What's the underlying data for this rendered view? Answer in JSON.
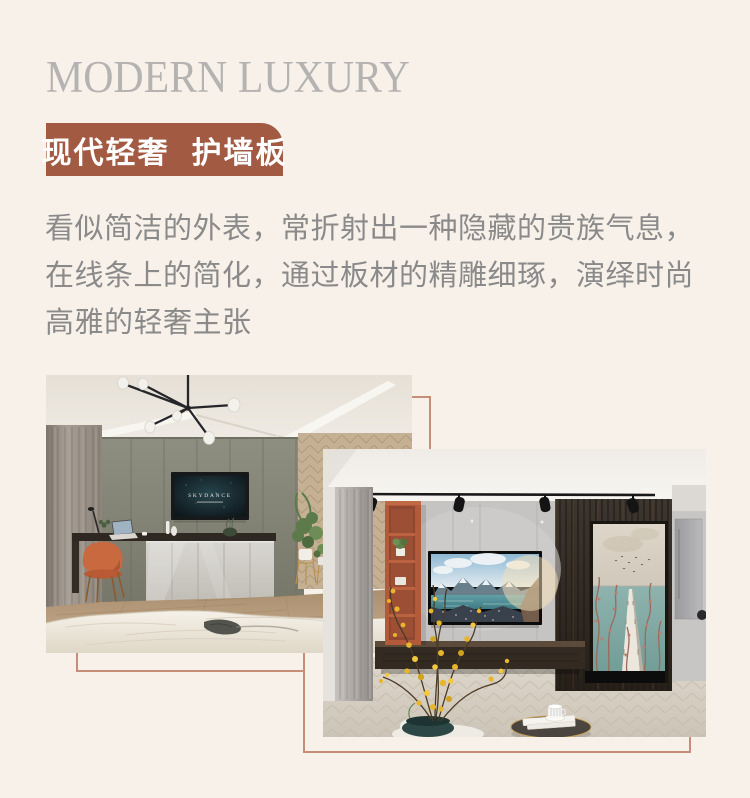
{
  "page": {
    "background_color": "#f8f1ea",
    "accent_color": "#a35a42",
    "frame_line_color": "#c68e76",
    "title_color": "#b5b3b1",
    "body_text_color": "#8a8a8a"
  },
  "hero": {
    "title": "MODERN LUXURY"
  },
  "badge": {
    "left": "现代轻奢",
    "right": "护墙板"
  },
  "intro": {
    "lines": [
      "看似简洁的外表，常折射出一种隐藏的贵族气息，",
      "在线条上的简化，通过板材的精雕细琢，演绎时尚",
      "高雅的轻奢主张"
    ]
  },
  "photos": {
    "photo1": {
      "tv_text": "SKYDANCE"
    }
  }
}
